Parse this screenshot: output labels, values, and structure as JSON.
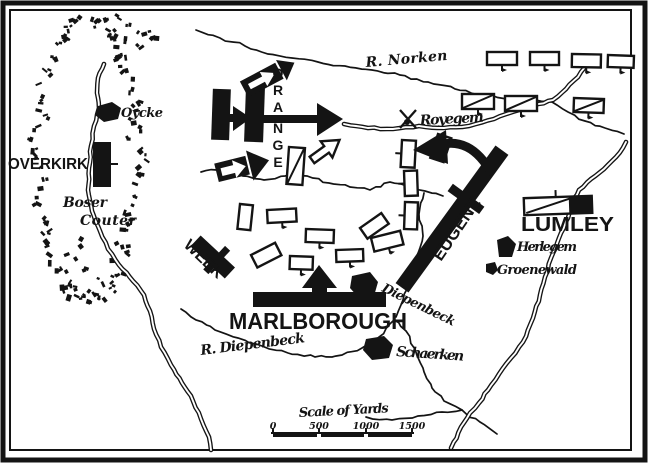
{
  "commanders": {
    "overkirk": "OVERKIRK",
    "orange": "ORANGE",
    "orange_letters": [
      "O",
      "R",
      "A",
      "N",
      "G",
      "E"
    ],
    "week": "WEEK",
    "marlborough": "MARLBOROUGH",
    "eugene": "EUGENE",
    "lumley": "LUMLEY"
  },
  "places": {
    "oycke": "Oycke",
    "boser": "Boser",
    "couter": "Couter",
    "royegem": "Royegem",
    "herlegem": "Herlegem",
    "groenewald": "Groenewald",
    "diepenbeck_village": "Diepenbeck",
    "schaerken": "Schaerken"
  },
  "rivers": {
    "norken": "R. Norken",
    "diepenbeck": "R. Diepenbeck"
  },
  "scale": {
    "title": "Scale of Yards",
    "ticks": [
      "0",
      "500",
      "1000",
      "1500"
    ]
  },
  "colors": {
    "ink": "#141414",
    "paper": "#ffffff"
  }
}
